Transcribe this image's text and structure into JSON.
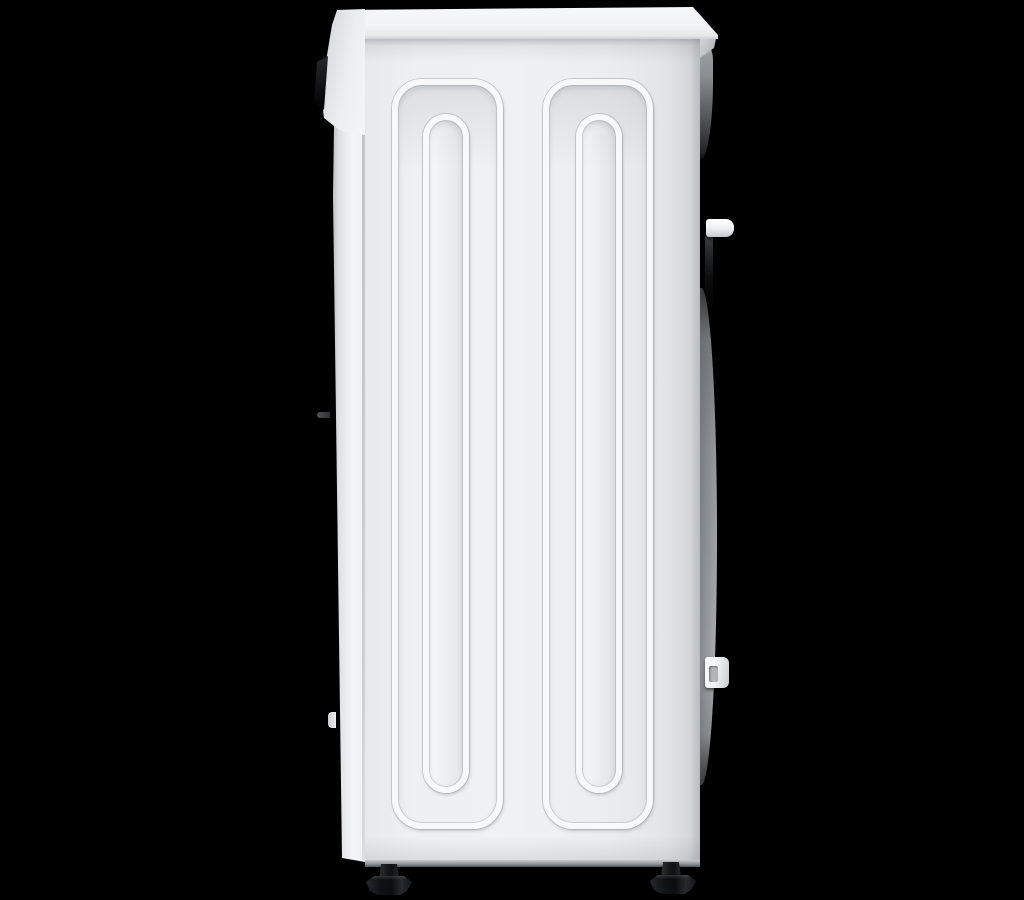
{
  "scene": {
    "title": "Side view of a white front-loading washing machine on a black background",
    "object_label": "washing machine",
    "view_label": "left side profile",
    "background_color": "#000000"
  },
  "palette": {
    "body_white": "#eff0f2",
    "panel_shade": "#d3d5d7",
    "ridge_highlight": "#f7f8fa",
    "display_black": "#121316",
    "rear_gray": "#9da0a2",
    "feet_black": "#121316"
  },
  "parts": {
    "lid": "top lid",
    "lid_lip": "rear lid overhang",
    "control_panel": "control panel edge",
    "display": "display glass edge",
    "side_panel": "side panel",
    "emboss_outer": "embossed stiffening channel (outer)",
    "emboss_inner": "embossed stiffening channel (inner)",
    "front_edge": "front panel edge",
    "door_nub": "door hinge nub",
    "door_tick": "door seam mark",
    "rear_bulge": "rear panel bulge",
    "clip_upper": "upper hose clip",
    "clip_lower": "lower hose clip",
    "foot_front": "adjustable leveling foot (front)",
    "foot_rear": "adjustable leveling foot (rear)"
  }
}
